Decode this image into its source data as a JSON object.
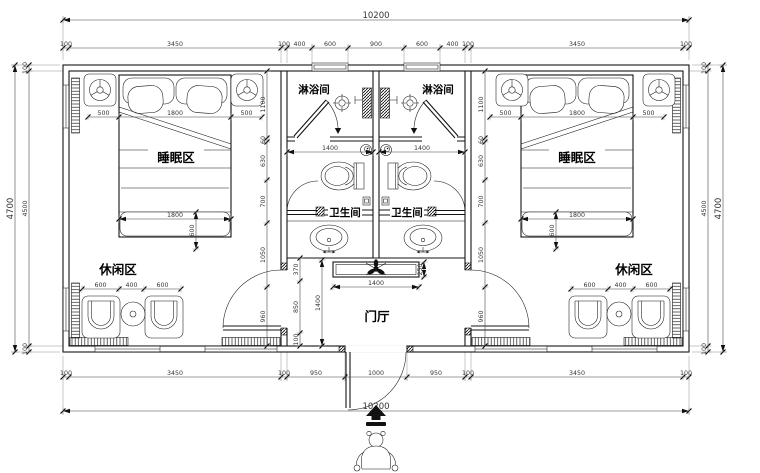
{
  "labels": {
    "shower_left": "淋浴间",
    "shower_right": "淋浴间",
    "wc_left": "卫生间",
    "wc_right": "卫生间",
    "sleep_left": "睡眠区",
    "sleep_right": "睡眠区",
    "leisure_left": "休闲区",
    "leisure_right": "休闲区",
    "foyer": "门厅"
  },
  "colors": {
    "line": "#141414",
    "dim_text": "#333333",
    "background": "#ffffff"
  },
  "dim_chains": [
    {
      "o": "h",
      "pos": 20,
      "ticks": [
        63,
        689
      ],
      "labels": [
        "10200"
      ],
      "big": true
    },
    {
      "o": "h",
      "pos": 48,
      "ticks": [
        63,
        69,
        281,
        287,
        312,
        348,
        404,
        440,
        465,
        471,
        683,
        689
      ],
      "labels": [
        "100",
        "3450",
        "100",
        "400",
        "600",
        "900",
        "600",
        "400",
        "100",
        "3450",
        "100"
      ]
    },
    {
      "o": "h",
      "pos": 377,
      "ticks": [
        63,
        69,
        281,
        287,
        345,
        407,
        465,
        471,
        683,
        689
      ],
      "labels": [
        "100",
        "3450",
        "100",
        "950",
        "1000",
        "950",
        "100",
        "3450",
        "100"
      ]
    },
    {
      "o": "h",
      "pos": 411,
      "ticks": [
        63,
        689
      ],
      "labels": [
        "10200"
      ],
      "big": true
    },
    {
      "o": "v",
      "pos": 15,
      "ticks": [
        65,
        352
      ],
      "labels": [
        "4700"
      ],
      "big": true
    },
    {
      "o": "v",
      "pos": 29,
      "ticks": [
        65,
        71,
        346,
        352
      ],
      "labels": [
        "100",
        "4500",
        "100"
      ]
    },
    {
      "o": "v",
      "pos": 708,
      "ticks": [
        65,
        71,
        346,
        352
      ],
      "labels": [
        "100",
        "4500",
        "100"
      ]
    },
    {
      "o": "v",
      "pos": 723,
      "ticks": [
        65,
        352
      ],
      "labels": [
        "4700"
      ],
      "big": true
    },
    {
      "o": "v",
      "pos": 267,
      "ticks": [
        71,
        138,
        142,
        180,
        223,
        287,
        346
      ],
      "labels": [
        "1100",
        "60",
        "630",
        "700",
        "1050",
        "960"
      ]
    },
    {
      "o": "v",
      "pos": 485,
      "ticks": [
        71,
        138,
        142,
        180,
        223,
        287,
        346
      ],
      "labels": [
        "1100",
        "60",
        "630",
        "700",
        "1050",
        "960"
      ]
    },
    {
      "o": "h",
      "pos": 117,
      "ticks": [
        88,
        119,
        231,
        262
      ],
      "labels": [
        "500",
        "1800",
        "500"
      ]
    },
    {
      "o": "h",
      "pos": 117,
      "ticks": [
        490,
        521,
        633,
        664
      ],
      "labels": [
        "500",
        "1800",
        "500"
      ]
    },
    {
      "o": "h",
      "pos": 219,
      "ticks": [
        119,
        231
      ],
      "labels": [
        "1800"
      ]
    },
    {
      "o": "h",
      "pos": 219,
      "ticks": [
        521,
        633
      ],
      "labels": [
        "1800"
      ]
    },
    {
      "o": "h",
      "pos": 289,
      "ticks": [
        82,
        119,
        144,
        181
      ],
      "labels": [
        "600",
        "400",
        "600"
      ]
    },
    {
      "o": "h",
      "pos": 289,
      "ticks": [
        571,
        608,
        633,
        670
      ],
      "labels": [
        "600",
        "400",
        "600"
      ]
    },
    {
      "o": "h",
      "pos": 152,
      "ticks": [
        287,
        373
      ],
      "labels": [
        "1400"
      ]
    },
    {
      "o": "h",
      "pos": 152,
      "ticks": [
        379,
        465
      ],
      "labels": [
        "1400"
      ]
    },
    {
      "o": "h",
      "pos": 287,
      "ticks": [
        333,
        419
      ],
      "labels": [
        "1400"
      ]
    },
    {
      "o": "v",
      "pos": 424,
      "ticks": [
        262,
        277
      ],
      "labels": [
        "250"
      ]
    },
    {
      "o": "v",
      "pos": 300,
      "ticks": [
        258,
        281,
        333,
        346
      ],
      "labels": [
        "370",
        "850",
        "100"
      ]
    },
    {
      "o": "v",
      "pos": 322,
      "ticks": [
        260,
        346
      ],
      "labels": [
        "1400"
      ]
    },
    {
      "o": "v",
      "pos": 196,
      "ticks": [
        212,
        249
      ],
      "labels": [
        "600"
      ]
    },
    {
      "o": "v",
      "pos": 556,
      "ticks": [
        212,
        249
      ],
      "labels": [
        "600"
      ]
    }
  ]
}
